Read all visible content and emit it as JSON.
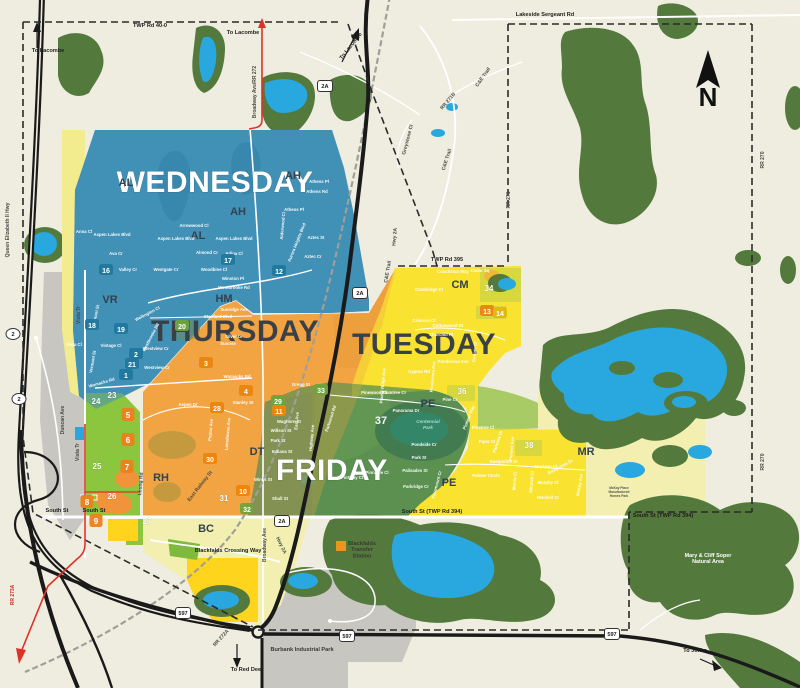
{
  "zones": {
    "wednesday": {
      "label": "WEDNESDAY",
      "color": "#4190B7"
    },
    "thursday": {
      "label": "THURSDAY",
      "color": "#F2A444"
    },
    "tuesday": {
      "label": "TUESDAY",
      "color": "#F9E331"
    },
    "friday": {
      "label": "FRIDAY",
      "color": "#5C9150"
    }
  },
  "compass": {
    "letter": "N"
  },
  "badge_colors": {
    "b": "#20789E",
    "o": "#E8860F",
    "g": "#6FA33C",
    "y": "#E3B70E",
    "m": "#EE7F1A"
  },
  "area_codes": [
    {
      "t": "AH",
      "x": 293,
      "y": 179
    },
    {
      "t": "AH",
      "x": 238,
      "y": 215
    },
    {
      "t": "AL",
      "x": 126,
      "y": 186
    },
    {
      "t": "AL",
      "x": 198,
      "y": 239
    },
    {
      "t": "VR",
      "x": 110,
      "y": 303
    },
    {
      "t": "HM",
      "x": 224,
      "y": 302
    },
    {
      "t": "CM",
      "x": 460,
      "y": 288
    },
    {
      "t": "DT",
      "x": 257,
      "y": 455
    },
    {
      "t": "RH",
      "x": 161,
      "y": 481
    },
    {
      "t": "BC",
      "x": 206,
      "y": 532
    },
    {
      "t": "PE",
      "x": 428,
      "y": 407
    },
    {
      "t": "PE",
      "x": 449,
      "y": 486
    },
    {
      "t": "MR",
      "x": 586,
      "y": 455
    }
  ],
  "zone_badges": [
    {
      "n": "16",
      "x": 106,
      "y": 273,
      "bg": "b"
    },
    {
      "n": "17",
      "x": 228,
      "y": 263,
      "bg": "b"
    },
    {
      "n": "12",
      "x": 279,
      "y": 274,
      "bg": "b"
    },
    {
      "n": "18",
      "x": 92,
      "y": 328,
      "bg": "b"
    },
    {
      "n": "19",
      "x": 121,
      "y": 332,
      "bg": "b"
    },
    {
      "n": "2",
      "x": 136,
      "y": 357,
      "bg": "b"
    },
    {
      "n": "21",
      "x": 132,
      "y": 367,
      "bg": "b"
    },
    {
      "n": "1",
      "x": 126,
      "y": 378,
      "bg": "b"
    },
    {
      "n": "20",
      "x": 182,
      "y": 329,
      "bg": "g"
    },
    {
      "n": "3",
      "x": 206,
      "y": 366,
      "bg": "o"
    },
    {
      "n": "4",
      "x": 246,
      "y": 394,
      "bg": "o"
    },
    {
      "n": "28",
      "x": 217,
      "y": 411,
      "bg": "o"
    },
    {
      "n": "30",
      "x": 210,
      "y": 462,
      "bg": "o"
    },
    {
      "n": "29",
      "x": 278,
      "y": 404,
      "bg": "g"
    },
    {
      "n": "11",
      "x": 279,
      "y": 414,
      "bg": "o"
    },
    {
      "n": "33",
      "x": 321,
      "y": 393,
      "bg": "g"
    },
    {
      "n": "31",
      "x": 224,
      "y": 501
    },
    {
      "n": "10",
      "x": 243,
      "y": 494,
      "bg": "o"
    },
    {
      "n": "32",
      "x": 247,
      "y": 512,
      "bg": "g"
    },
    {
      "n": "37",
      "x": 381,
      "y": 424,
      "big": true
    },
    {
      "n": "23",
      "x": 112,
      "y": 398
    },
    {
      "n": "24",
      "x": 96,
      "y": 404
    },
    {
      "n": "25",
      "x": 97,
      "y": 469
    },
    {
      "n": "26",
      "x": 112,
      "y": 499
    },
    {
      "n": "27",
      "x": 147,
      "y": 524
    },
    {
      "n": "34",
      "x": 489,
      "y": 291
    },
    {
      "n": "36",
      "x": 462,
      "y": 394
    },
    {
      "n": "13",
      "x": 487,
      "y": 314,
      "bg": "o"
    },
    {
      "n": "14",
      "x": 500,
      "y": 316,
      "bg": "y"
    },
    {
      "n": "38",
      "x": 529,
      "y": 448
    },
    {
      "n": "5",
      "x": 128,
      "y": 418,
      "bg": "m"
    },
    {
      "n": "6",
      "x": 128,
      "y": 443,
      "bg": "m"
    },
    {
      "n": "7",
      "x": 127,
      "y": 470,
      "bg": "m"
    },
    {
      "n": "8",
      "x": 87,
      "y": 505,
      "bg": "m"
    },
    {
      "n": "9",
      "x": 96,
      "y": 524,
      "bg": "m"
    }
  ],
  "road_labels": [
    {
      "t": "TWP Rd 40-0",
      "x": 150,
      "y": 27,
      "b": 1
    },
    {
      "t": "Lakeside Sergeant Rd",
      "x": 545,
      "y": 16,
      "b": 1
    },
    {
      "t": "To Lacombe",
      "x": 48,
      "y": 52,
      "b": 1
    },
    {
      "t": "To Lacombe",
      "x": 243,
      "y": 34,
      "b": 1
    },
    {
      "t": "To Lacombe",
      "x": 352,
      "y": 47,
      "r": -52,
      "b": 1
    },
    {
      "t": "Broadway Ave/RR 272",
      "x": 256,
      "y": 92,
      "r": -90
    },
    {
      "t": "Queen Elizabeth II Hwy",
      "x": 9,
      "y": 230,
      "r": -90
    },
    {
      "t": "C&E Trail",
      "x": 484,
      "y": 78,
      "r": -55
    },
    {
      "t": "RR 271B",
      "x": 449,
      "y": 102,
      "r": -50
    },
    {
      "t": "Greystone Cl",
      "x": 409,
      "y": 140,
      "r": -75
    },
    {
      "t": "C&E Trail",
      "x": 448,
      "y": 160,
      "r": -72
    },
    {
      "t": "RR 271",
      "x": 510,
      "y": 200,
      "r": -90
    },
    {
      "t": "RR 270",
      "x": 764,
      "y": 160,
      "r": -90
    },
    {
      "t": "RR 270",
      "x": 764,
      "y": 462,
      "r": -90
    },
    {
      "t": "TWP Rd 395",
      "x": 447,
      "y": 261,
      "b": 1
    },
    {
      "t": "C&E Trail",
      "x": 389,
      "y": 272,
      "r": -80
    },
    {
      "t": "Hwy 2A",
      "x": 396,
      "y": 237,
      "r": -85
    },
    {
      "t": "Duncan Ave",
      "x": 64,
      "y": 420,
      "r": -90
    },
    {
      "t": "Vista Tr",
      "x": 80,
      "y": 315,
      "r": -90
    },
    {
      "t": "Vista Tr",
      "x": 79,
      "y": 452,
      "r": -90
    },
    {
      "t": "South St",
      "x": 57,
      "y": 512,
      "b": 1
    },
    {
      "t": "South St",
      "x": 94,
      "y": 512,
      "b": 1
    },
    {
      "t": "South St (TWP Rd 394)",
      "x": 432,
      "y": 513,
      "b": 1
    },
    {
      "t": "South St (TWP Rd 394)",
      "x": 663,
      "y": 517,
      "b": 1
    },
    {
      "t": "East Railway St",
      "x": 201,
      "y": 487,
      "r": -52
    },
    {
      "t": "Leung Rd",
      "x": 142,
      "y": 484,
      "r": -85
    },
    {
      "t": "RR 272A",
      "x": 222,
      "y": 639,
      "r": -48
    },
    {
      "t": "RR 273A",
      "x": 14,
      "y": 595,
      "r": -90,
      "red": 1
    },
    {
      "t": "Hwy 2A",
      "x": 280,
      "y": 546,
      "r": 64
    },
    {
      "t": "Broadway Ave",
      "x": 266,
      "y": 545,
      "r": -90
    },
    {
      "t": "Blackfalds Crossing Way",
      "x": 228,
      "y": 552,
      "b": 1
    },
    {
      "t": "To Red Deer",
      "x": 247,
      "y": 671,
      "b": 1
    },
    {
      "t": "To Joffre",
      "x": 695,
      "y": 652,
      "b": 1
    }
  ],
  "street_labels": [
    {
      "t": "Ava Cr",
      "x": 116,
      "y": 255
    },
    {
      "t": "Valley Cr",
      "x": 128,
      "y": 271
    },
    {
      "t": "Westgate Cr",
      "x": 166,
      "y": 271
    },
    {
      "t": "Almond Cr",
      "x": 207,
      "y": 254
    },
    {
      "t": "Adina Cl",
      "x": 234,
      "y": 255
    },
    {
      "t": "Woodbine Cl",
      "x": 214,
      "y": 271
    },
    {
      "t": "Winston Pl",
      "x": 233,
      "y": 280
    },
    {
      "t": "Westbrooke Rd",
      "x": 234,
      "y": 289
    },
    {
      "t": "Westbrooke Rd",
      "x": 152,
      "y": 338,
      "r": -62
    },
    {
      "t": "Valmont St",
      "x": 97,
      "y": 316,
      "r": -78
    },
    {
      "t": "Vermont St",
      "x": 94,
      "y": 362,
      "r": -80
    },
    {
      "t": "Vintage Cl",
      "x": 111,
      "y": 347
    },
    {
      "t": "Vista Cl",
      "x": 74,
      "y": 346
    },
    {
      "t": "Anna Cl",
      "x": 84,
      "y": 233
    },
    {
      "t": "Aspen Lakes Blvd",
      "x": 112,
      "y": 236
    },
    {
      "t": "Aspen Lakes Blvd",
      "x": 176,
      "y": 240
    },
    {
      "t": "Aspen Lakes Blvd",
      "x": 234,
      "y": 240
    },
    {
      "t": "Arrowwood Cl",
      "x": 194,
      "y": 227
    },
    {
      "t": "Athens Pl",
      "x": 319,
      "y": 183
    },
    {
      "t": "Athens Rd",
      "x": 317,
      "y": 193
    },
    {
      "t": "Athens Pl",
      "x": 294,
      "y": 211
    },
    {
      "t": "Alderwood Cl",
      "x": 284,
      "y": 226,
      "r": -85
    },
    {
      "t": "Aurora Heights Blvd",
      "x": 298,
      "y": 243,
      "r": -68
    },
    {
      "t": "Aztec St",
      "x": 316,
      "y": 239
    },
    {
      "t": "Aztec Cr",
      "x": 313,
      "y": 258
    },
    {
      "t": "Wellington Cl",
      "x": 148,
      "y": 315,
      "r": -28
    },
    {
      "t": "Stanford Blvd",
      "x": 218,
      "y": 318
    },
    {
      "t": "Sunridge Ave",
      "x": 234,
      "y": 311
    },
    {
      "t": "Silver Dr",
      "x": 234,
      "y": 338
    },
    {
      "t": "Sunrise",
      "x": 228,
      "y": 345
    },
    {
      "t": "Westview Cr",
      "x": 156,
      "y": 350
    },
    {
      "t": "Westview Cr",
      "x": 157,
      "y": 369
    },
    {
      "t": "Womacks Rd",
      "x": 102,
      "y": 384,
      "r": -16
    },
    {
      "t": "Womacks Rd",
      "x": 237,
      "y": 378
    },
    {
      "t": "Stanley St",
      "x": 243,
      "y": 404
    },
    {
      "t": "Gregg St",
      "x": 301,
      "y": 386
    },
    {
      "t": "Aspen Dr",
      "x": 188,
      "y": 406
    },
    {
      "t": "Poplar Ave",
      "x": 212,
      "y": 430,
      "r": -85
    },
    {
      "t": "Lansdowne Ave",
      "x": 229,
      "y": 434,
      "r": -85
    },
    {
      "t": "Coachman Way",
      "x": 453,
      "y": 273
    },
    {
      "t": "Cedar Sq",
      "x": 480,
      "y": 272
    },
    {
      "t": "Cambridge Cl",
      "x": 429,
      "y": 291
    },
    {
      "t": "Crimson Cl",
      "x": 424,
      "y": 322
    },
    {
      "t": "Cottonwood Dr",
      "x": 448,
      "y": 327
    },
    {
      "t": "Churchill Pl",
      "x": 441,
      "y": 336
    },
    {
      "t": "Cooper Cl",
      "x": 476,
      "y": 352,
      "r": -85
    },
    {
      "t": "Ponderosa Ave",
      "x": 453,
      "y": 363
    },
    {
      "t": "Ponderosa Ave",
      "x": 434,
      "y": 377,
      "r": -85
    },
    {
      "t": "Cyprus Rd",
      "x": 419,
      "y": 373
    },
    {
      "t": "Pine Cr",
      "x": 450,
      "y": 401
    },
    {
      "t": "Pioneer Way",
      "x": 470,
      "y": 418,
      "r": -68
    },
    {
      "t": "Prairie Ridge Ave",
      "x": 384,
      "y": 386,
      "r": -85
    },
    {
      "t": "Plumtree Cr",
      "x": 394,
      "y": 394
    },
    {
      "t": "Pinewood Cl",
      "x": 374,
      "y": 394
    },
    {
      "t": "Pinetree Cl",
      "x": 483,
      "y": 429
    },
    {
      "t": "Piper Cl",
      "x": 487,
      "y": 443
    },
    {
      "t": "Pioneer Ave",
      "x": 513,
      "y": 449,
      "r": -85
    },
    {
      "t": "Parkway Dr",
      "x": 499,
      "y": 442,
      "r": -72
    },
    {
      "t": "Eastpointe Dr",
      "x": 504,
      "y": 463
    },
    {
      "t": "Eastpointe Dr",
      "x": 561,
      "y": 468,
      "r": -28
    },
    {
      "t": "Palmer Circle",
      "x": 486,
      "y": 477
    },
    {
      "t": "Morris Cl",
      "x": 516,
      "y": 481,
      "r": -85
    },
    {
      "t": "Maclean Cl",
      "x": 546,
      "y": 468
    },
    {
      "t": "Murphy Cl",
      "x": 548,
      "y": 484
    },
    {
      "t": "Mitchell Cl",
      "x": 533,
      "y": 482,
      "r": -85
    },
    {
      "t": "Mitchell Cr",
      "x": 548,
      "y": 499
    },
    {
      "t": "McKay Ave",
      "x": 581,
      "y": 485,
      "r": -80
    },
    {
      "t": "Waghorn St",
      "x": 289,
      "y": 423
    },
    {
      "t": "Willson St",
      "x": 281,
      "y": 432
    },
    {
      "t": "Park St",
      "x": 278,
      "y": 442
    },
    {
      "t": "Indiana St",
      "x": 282,
      "y": 453
    },
    {
      "t": "Winks St",
      "x": 263,
      "y": 481
    },
    {
      "t": "Shull St",
      "x": 280,
      "y": 500
    },
    {
      "t": "East Ave",
      "x": 298,
      "y": 421,
      "r": -85
    },
    {
      "t": "Highway Ave",
      "x": 313,
      "y": 438,
      "r": -85
    },
    {
      "t": "Parkwood Rd",
      "x": 332,
      "y": 419,
      "r": -72
    },
    {
      "t": "Panorama Dr",
      "x": 406,
      "y": 412
    },
    {
      "t": "Pondside Cr",
      "x": 424,
      "y": 446
    },
    {
      "t": "Park St",
      "x": 419,
      "y": 459
    },
    {
      "t": "Palisades St",
      "x": 415,
      "y": 472
    },
    {
      "t": "Parkridge Cr",
      "x": 416,
      "y": 488
    },
    {
      "t": "Paramount Cr",
      "x": 438,
      "y": 485,
      "r": -75
    },
    {
      "t": "Pinnacle Cl",
      "x": 377,
      "y": 474
    },
    {
      "t": "Portway Cl",
      "x": 352,
      "y": 479
    }
  ],
  "shields": [
    {
      "t": "2A",
      "x": 325,
      "y": 88
    },
    {
      "t": "2A",
      "x": 360,
      "y": 295
    },
    {
      "t": "2A",
      "x": 282,
      "y": 523
    },
    {
      "t": "597",
      "x": 183,
      "y": 615
    },
    {
      "t": "597",
      "x": 347,
      "y": 638
    },
    {
      "t": "597",
      "x": 612,
      "y": 636
    },
    {
      "t": "2",
      "x": 13,
      "y": 336,
      "oval": 1
    },
    {
      "t": "2",
      "x": 19,
      "y": 401,
      "oval": 1
    }
  ],
  "pois": [
    {
      "lines": [
        "Burbank Industrial Park"
      ],
      "x": 302,
      "y": 651,
      "cls": "poib"
    },
    {
      "lines": [
        "Blackfalds",
        "Transfer",
        "Station"
      ],
      "x": 362,
      "y": 545,
      "cls": "poib"
    },
    {
      "lines": [
        "Mary & Cliff Soper",
        "Natural Area"
      ],
      "x": 708,
      "y": 557,
      "cls": "poiw"
    },
    {
      "lines": [
        "Centennial",
        "Park"
      ],
      "x": 428,
      "y": 423,
      "cls": "park"
    },
    {
      "lines": [
        "McKay Place",
        "Manufactured",
        "Homes Park"
      ],
      "x": 619,
      "y": 489,
      "cls": "tiny"
    }
  ]
}
